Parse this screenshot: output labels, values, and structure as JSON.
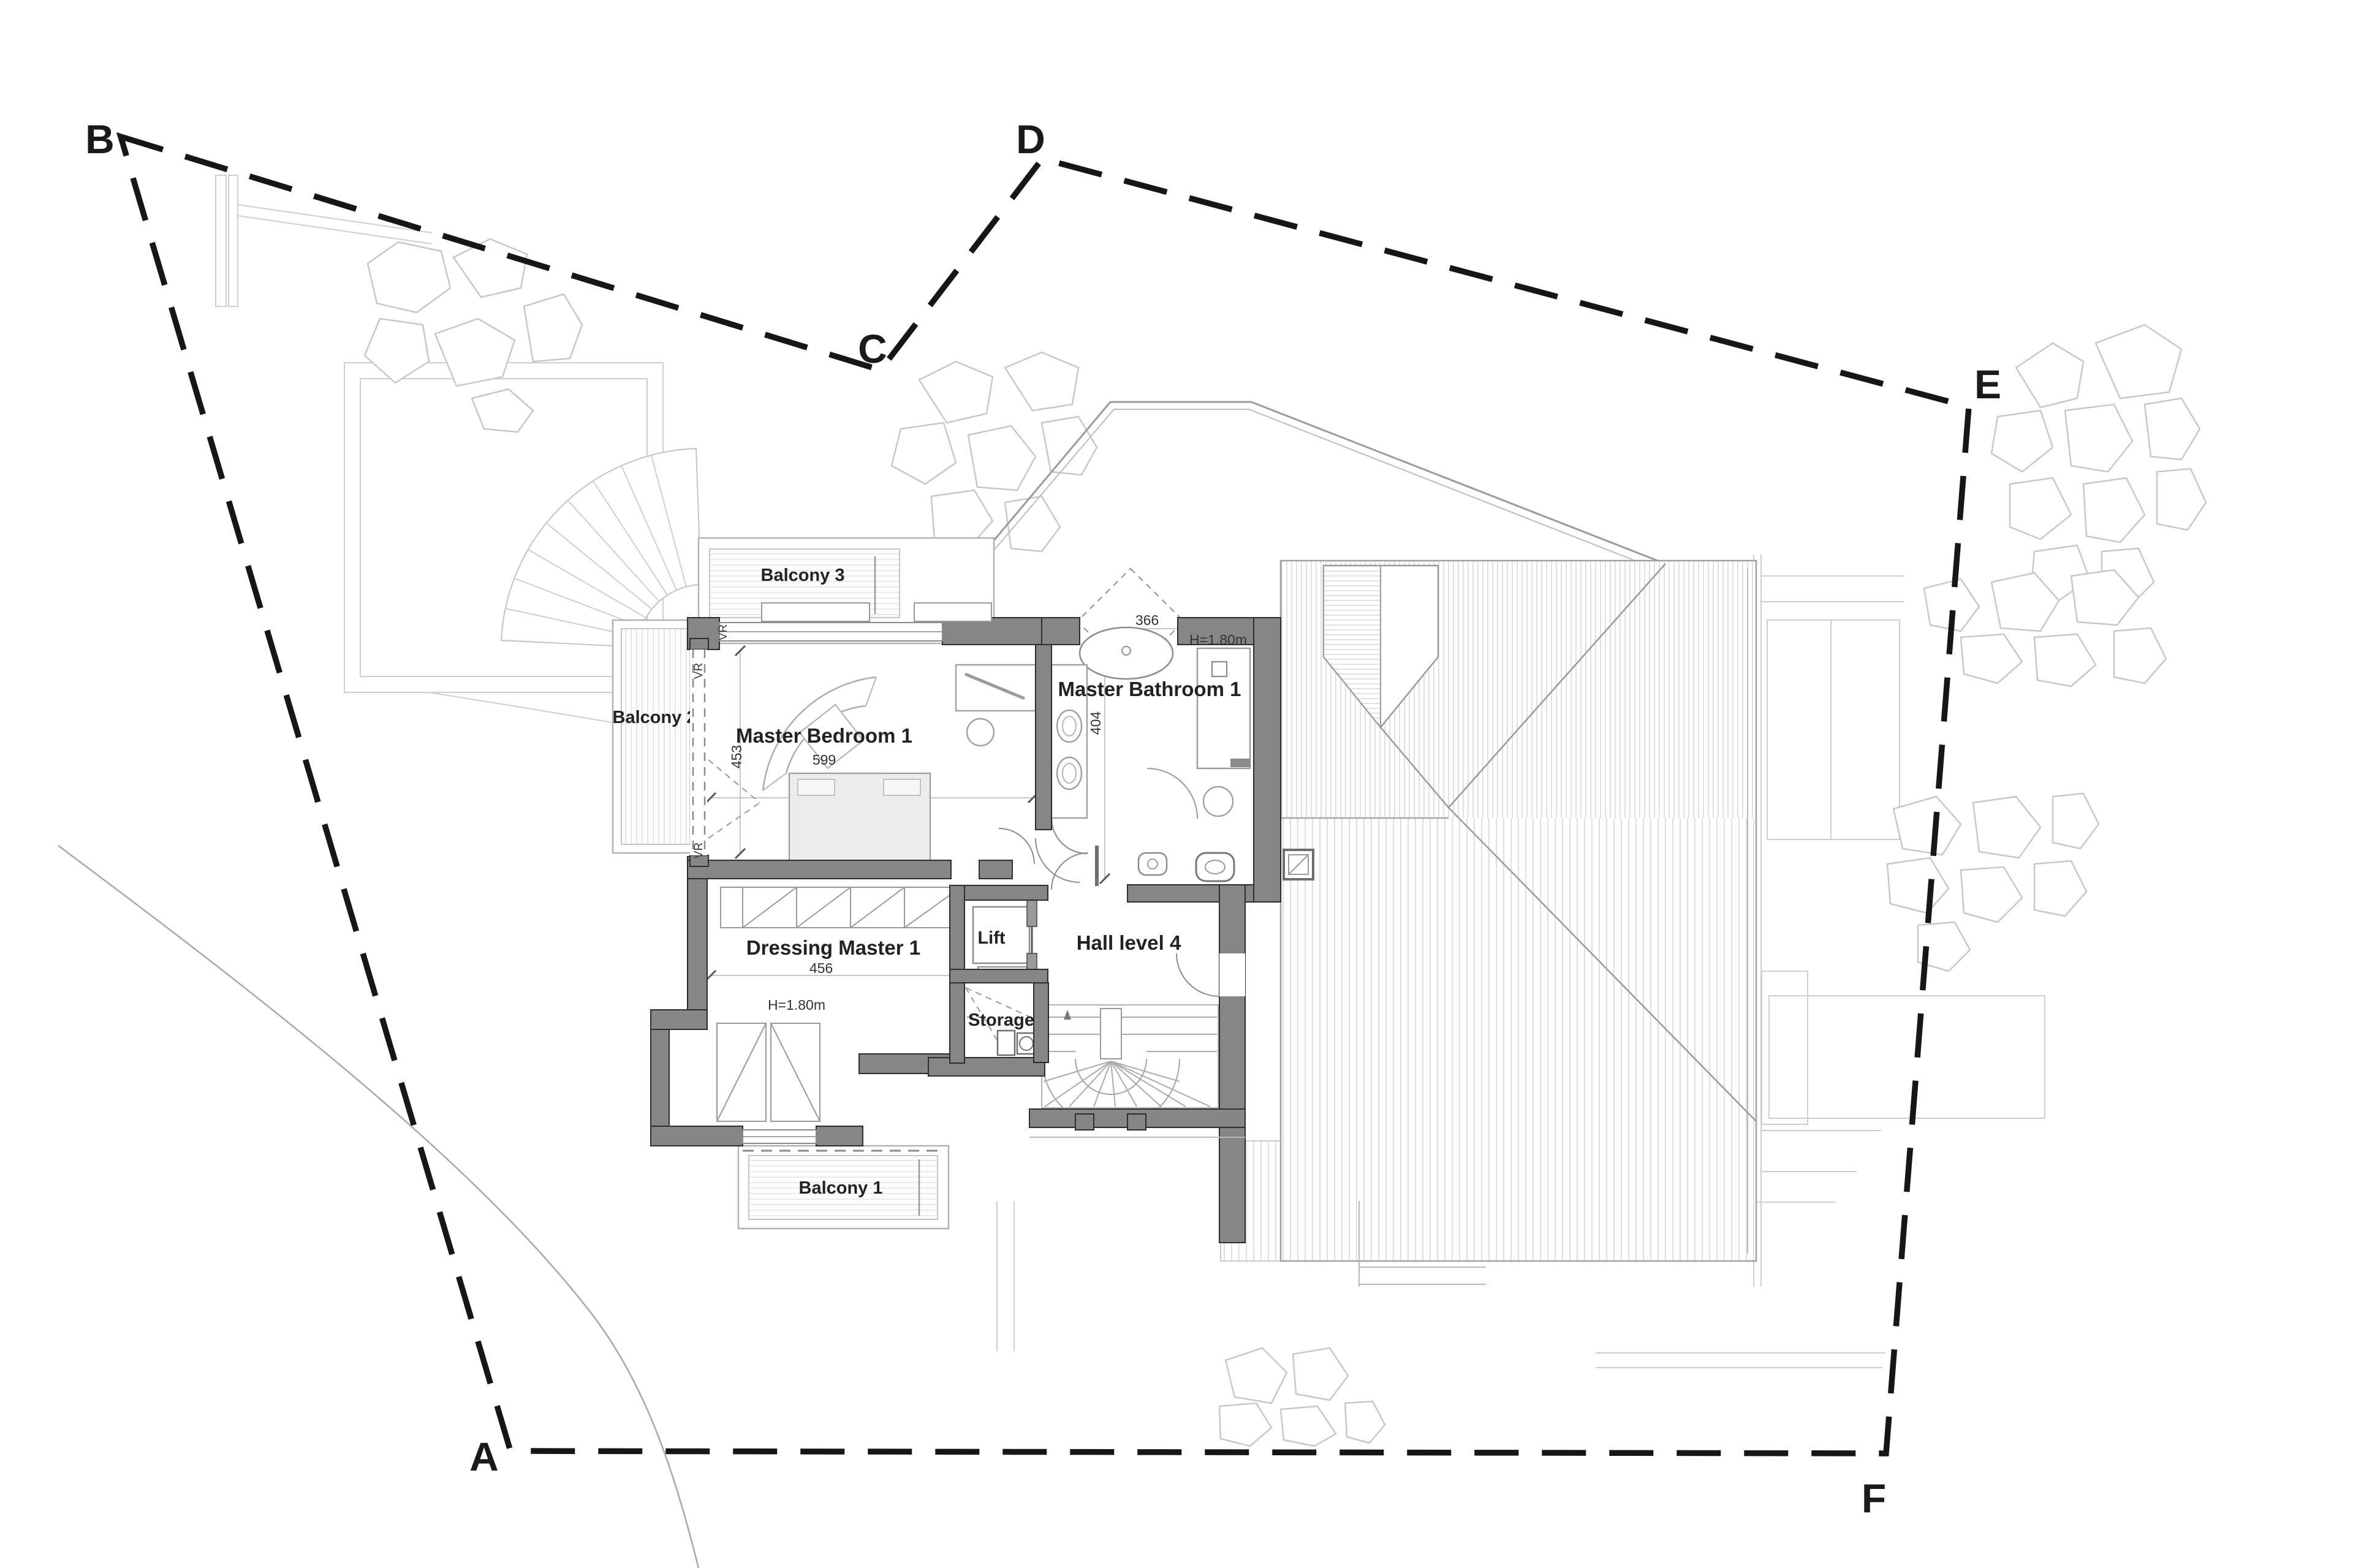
{
  "figure": {
    "type": "architectural-floor-plan",
    "level": "Level 4 / master suite with roof plan",
    "background": "#ffffff"
  },
  "colors": {
    "boundary_line": "#161616",
    "wall_fill": "#868686",
    "wall_edge": "#2e2e2e",
    "hatch_line": "#c9c9c9",
    "faint_line": "#cfcfcf",
    "text": "#1a1a1a"
  },
  "site": {
    "markers": [
      {
        "label": "B"
      },
      {
        "label": "C"
      },
      {
        "label": "D"
      },
      {
        "label": "E"
      },
      {
        "label": "F"
      },
      {
        "label": "A"
      }
    ]
  },
  "rooms": {
    "balcony3": {
      "label": "Balcony 3"
    },
    "balcony2": {
      "label": "Balcony 2"
    },
    "balcony1": {
      "label": "Balcony 1"
    },
    "master_bedroom": {
      "label": "Master Bedroom 1",
      "dimension": "599"
    },
    "master_bathroom": {
      "label": "Master Bathroom 1",
      "dimension_width": "404",
      "dimension_door": "366",
      "height_note": "H=1.80m"
    },
    "dressing": {
      "label": "Dressing Master 1",
      "dimension": "456",
      "height_note": "H=1.80m"
    },
    "lift": {
      "label": "Lift"
    },
    "storage": {
      "label": "Storage"
    },
    "hall": {
      "label": "Hall level 4"
    }
  },
  "annotations": {
    "balcony_door_dimension": "453",
    "shutter_marker": "VR"
  }
}
